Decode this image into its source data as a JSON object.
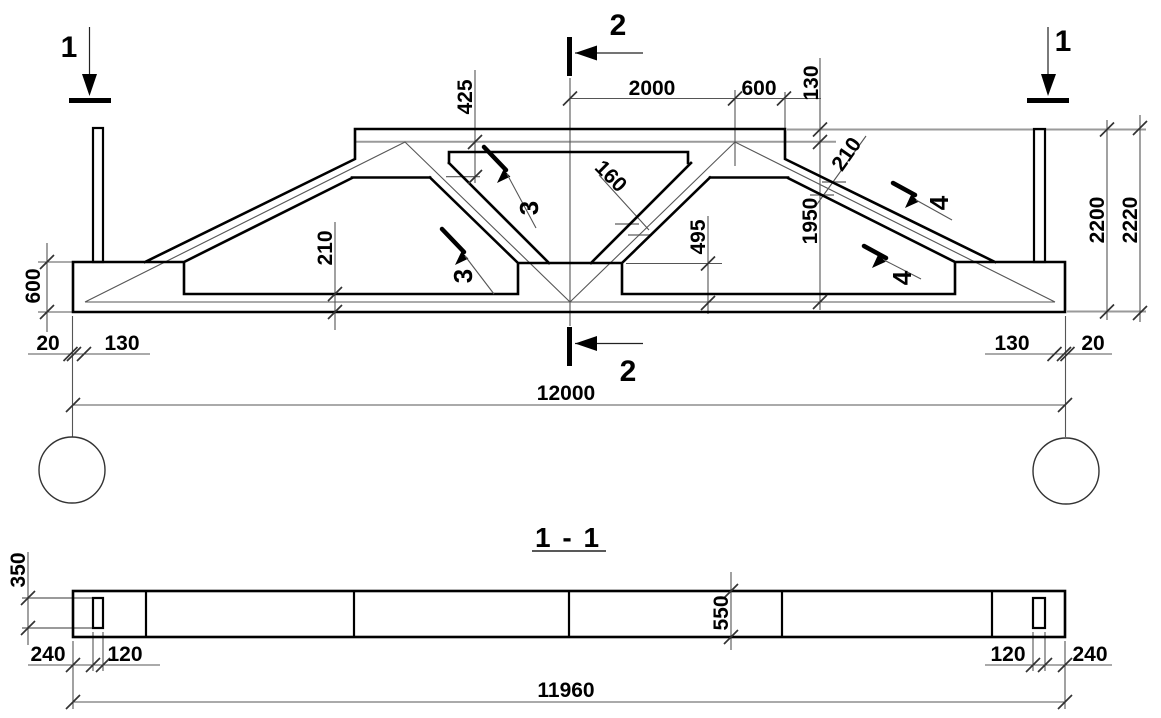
{
  "drawing": {
    "type": "structural elevation and section of a 12 m truss girder",
    "section_view_title": "1 - 1"
  },
  "markers": {
    "s1_left": "1",
    "s1_right": "1",
    "s2_top": "2",
    "s2_bottom": "2",
    "cut3_upper": "3",
    "cut3_lower": "3",
    "cut4_upper": "4",
    "cut4_lower": "4"
  },
  "dims_main": {
    "span": "12000",
    "top_a": "2000",
    "top_b": "600",
    "flange_step": "130",
    "crown_depth": "425",
    "diagonal_width": "160",
    "seat_height": "495",
    "mid_height": "1950",
    "height_a": "2200",
    "height_b": "2220",
    "end_height": "600",
    "chord_thك_left": "210",
    "chord_thk_left": "210",
    "chord_thk_right": "210",
    "off_left_20": "20",
    "off_left_130": "130",
    "off_right_130": "130",
    "off_right_20": "20"
  },
  "dims_section": {
    "span": "11960",
    "post_depth": "350",
    "end_left": "240",
    "post_left": "120",
    "depth": "550",
    "post_right": "120",
    "end_right": "240"
  },
  "colors": {
    "outline": "#000000",
    "thin_lines": "#555555",
    "aux_lines": "#9a9a9a",
    "background": "#ffffff"
  }
}
